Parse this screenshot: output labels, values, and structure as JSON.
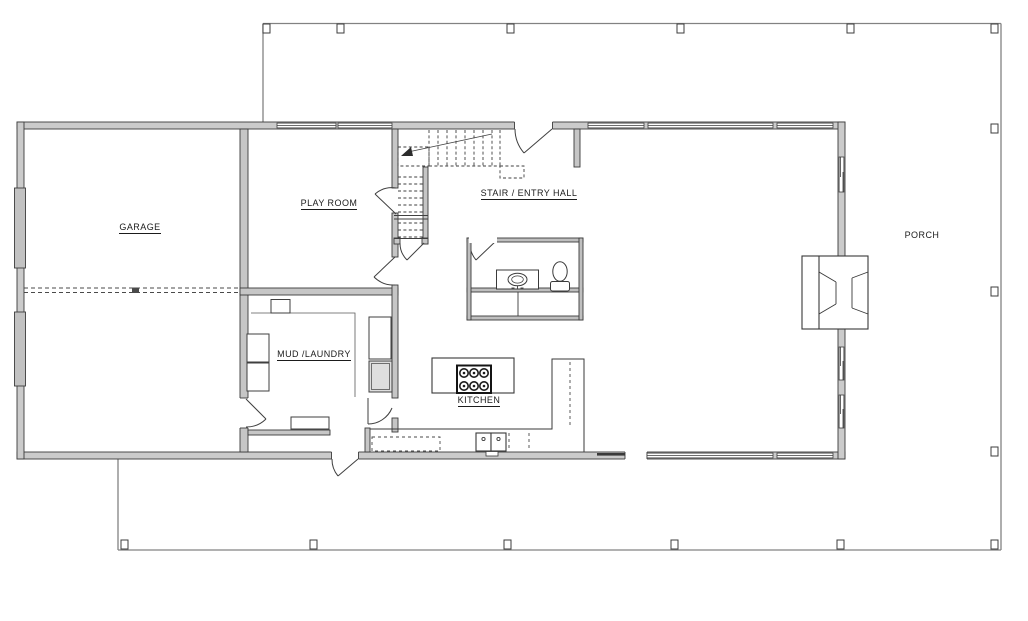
{
  "drawing": {
    "type": "residential-first-floor-plan"
  },
  "rooms": {
    "garage": {
      "label": "GARAGE"
    },
    "play_room": {
      "label": "PLAY ROOM"
    },
    "stair_entry_hall": {
      "label": "STAIR / ENTRY HALL"
    },
    "mud_laundry": {
      "label": "MUD /LAUNDRY"
    },
    "kitchen": {
      "label": "KITCHEN"
    },
    "porch": {
      "label": "PORCH"
    }
  },
  "fixtures": [
    "staircase",
    "six-burner-cooktop",
    "kitchen-island",
    "kitchen-counter",
    "double-basin-sink",
    "dishwasher",
    "bathroom-vanity-sink",
    "toilet",
    "under-bath-closet",
    "fireplace",
    "washer",
    "dryer",
    "mud-room-bench",
    "mud-room-cabinets",
    "garage-overhead-door-track",
    "porch-posts",
    "door-swings",
    "windows"
  ],
  "colors": {
    "background": "#ffffff",
    "wall_fill": "#cbcbcb",
    "wall_outline": "#3c3c3c",
    "porch_line": "#808080",
    "label_text": "#1b1b1b"
  }
}
